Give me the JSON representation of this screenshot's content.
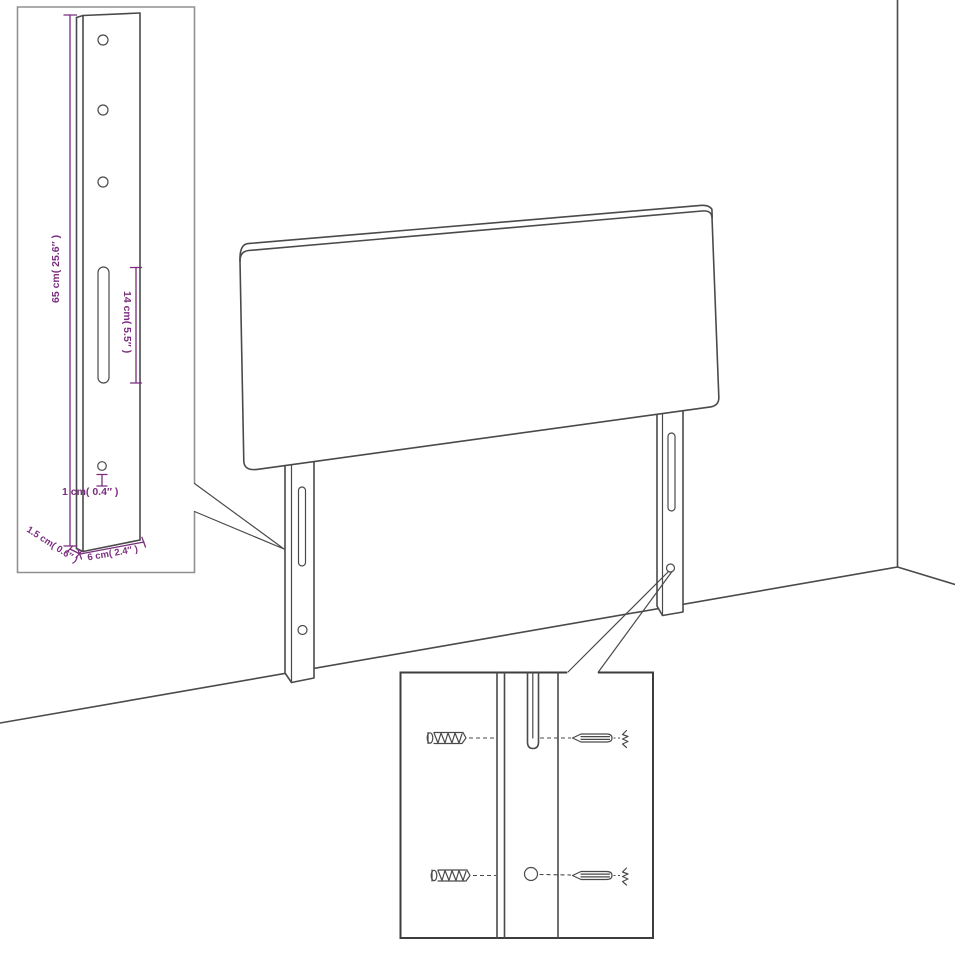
{
  "diagram": {
    "subject": "Headboard with two wall-mounting legs, dimension diagram",
    "palette": {
      "line": "#4a4a4a",
      "dimension_text": "#7b2d7f",
      "inset_top_border": "#909090",
      "inset_bottom_border": "#3d3d3d",
      "background": "#ffffff"
    },
    "labels": {
      "leg_height": "65 cm( 25.6″ )",
      "slot_length": "14 cm( 5.5″ )",
      "hole_offset": "1 cm( 0.4″ )",
      "leg_thickness": "1.5 cm( 0.6″ )",
      "leg_width": "6 cm( 2.4″ )"
    }
  }
}
